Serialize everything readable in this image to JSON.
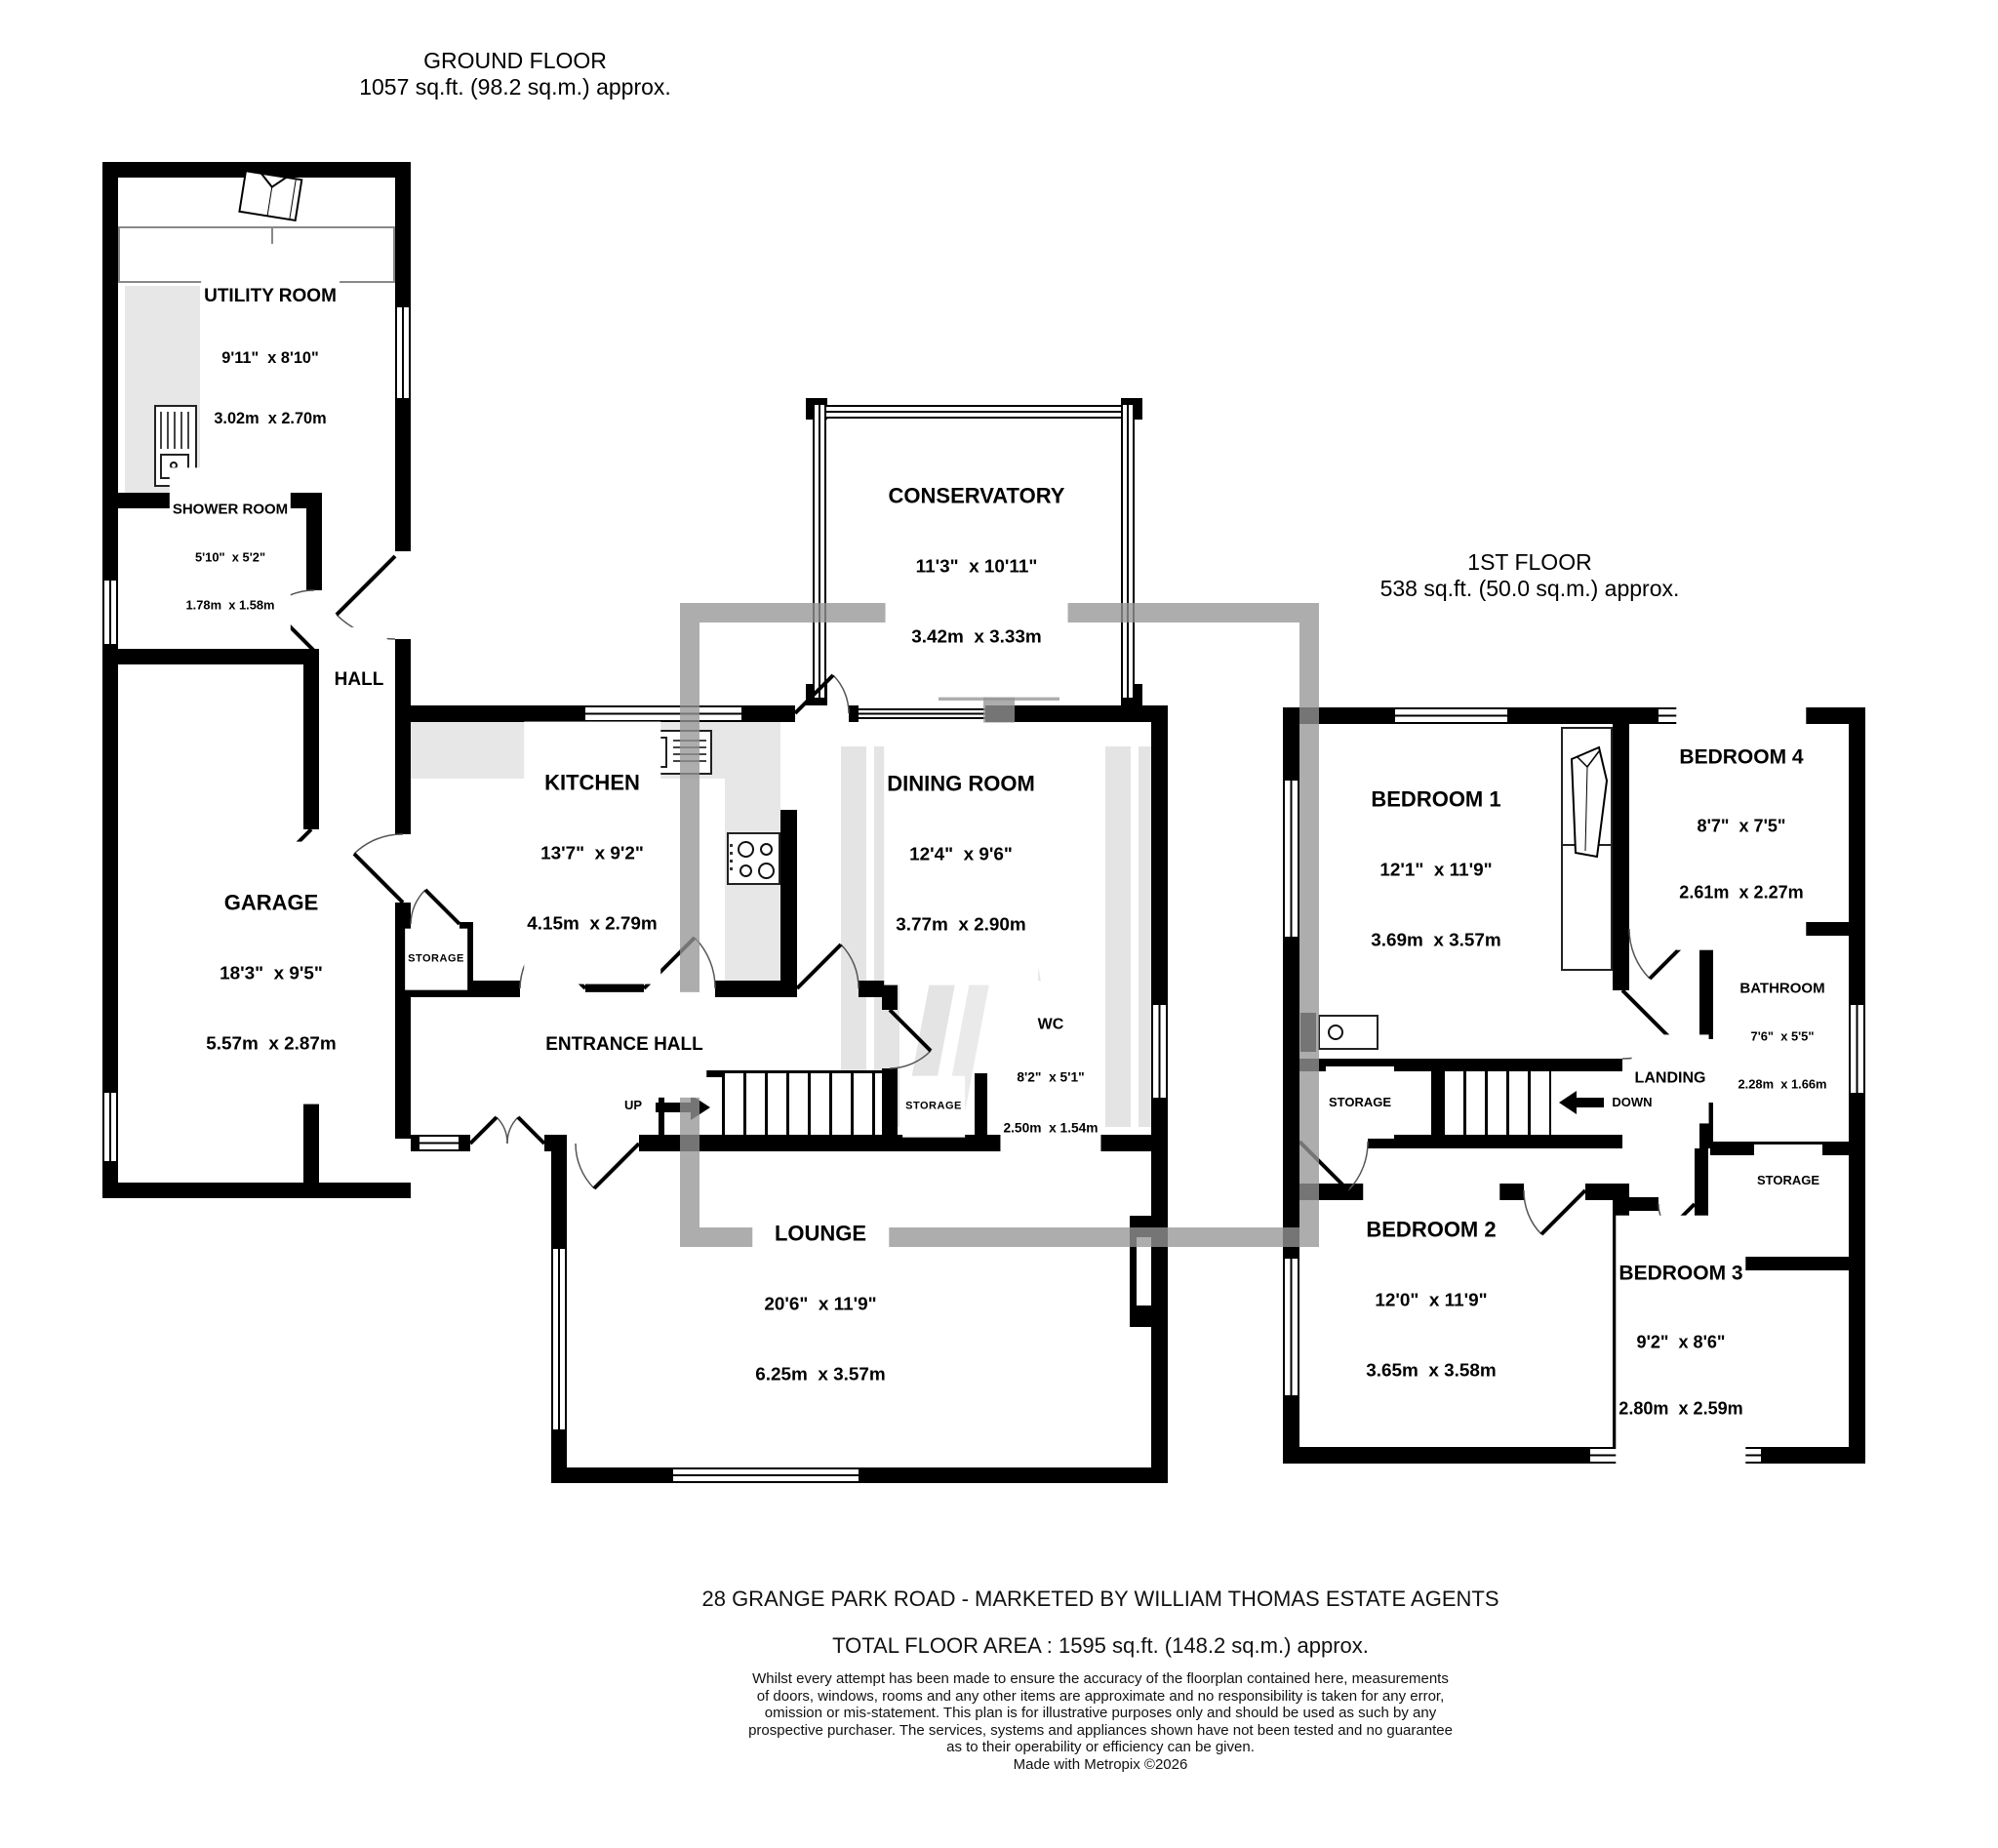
{
  "floors": {
    "ground": {
      "title": "GROUND FLOOR",
      "subtitle": "1057 sq.ft. (98.2 sq.m.) approx."
    },
    "first": {
      "title": "1ST FLOOR",
      "subtitle": "538 sq.ft. (50.0 sq.m.) approx."
    }
  },
  "rooms": {
    "utility": {
      "name": "UTILITY ROOM",
      "ft": "9'11\"  x 8'10\"",
      "m": "3.02m  x 2.70m"
    },
    "shower": {
      "name": "SHOWER ROOM",
      "ft": "5'10\"  x 5'2\"",
      "m": "1.78m  x 1.58m"
    },
    "hall": {
      "name": "HALL"
    },
    "garage": {
      "name": "GARAGE",
      "ft": "18'3\"  x 9'5\"",
      "m": "5.57m  x 2.87m"
    },
    "kitchen": {
      "name": "KITCHEN",
      "ft": "13'7\"  x 9'2\"",
      "m": "4.15m  x 2.79m"
    },
    "conservatory": {
      "name": "CONSERVATORY",
      "ft": "11'3\"  x 10'11\"",
      "m": "3.42m  x 3.33m"
    },
    "dining": {
      "name": "DINING ROOM",
      "ft": "12'4\"  x 9'6\"",
      "m": "3.77m  x 2.90m"
    },
    "entrance": {
      "name": "ENTRANCE HALL"
    },
    "wc": {
      "name": "WC",
      "ft": "8'2\"  x 5'1\"",
      "m": "2.50m  x 1.54m"
    },
    "storage_g1": {
      "name": "STORAGE"
    },
    "storage_g2": {
      "name": "STORAGE"
    },
    "lounge": {
      "name": "LOUNGE",
      "ft": "20'6\"  x 11'9\"",
      "m": "6.25m  x 3.57m"
    },
    "bed1": {
      "name": "BEDROOM 1",
      "ft": "12'1\"  x 11'9\"",
      "m": "3.69m  x 3.57m"
    },
    "bed2": {
      "name": "BEDROOM 2",
      "ft": "12'0\"  x 11'9\"",
      "m": "3.65m  x 3.58m"
    },
    "bed3": {
      "name": "BEDROOM 3",
      "ft": "9'2\"  x 8'6\"",
      "m": "2.80m  x 2.59m"
    },
    "bed4": {
      "name": "BEDROOM 4",
      "ft": "8'7\"  x 7'5\"",
      "m": "2.61m  x 2.27m"
    },
    "bathroom": {
      "name": "BATHROOM",
      "ft": "7'6\"  x 5'5\"",
      "m": "2.28m  x 1.66m"
    },
    "landing": {
      "name": "LANDING"
    },
    "storage_f1": {
      "name": "STORAGE"
    },
    "storage_f2": {
      "name": "STORAGE"
    }
  },
  "labels": {
    "up": "UP",
    "down": "DOWN"
  },
  "footer": {
    "address": "28 GRANGE PARK ROAD - MARKETED BY WILLIAM THOMAS ESTATE AGENTS",
    "total": "TOTAL FLOOR AREA : 1595 sq.ft. (148.2 sq.m.) approx.",
    "disclaimer_lines": [
      "Whilst every attempt has been made to ensure the accuracy of the floorplan contained here, measurements",
      "of doors, windows, rooms and any other items are approximate and no responsibility is taken for any error,",
      "omission or mis-statement. This plan is for illustrative purposes only and should be used as such by any",
      "prospective purchaser. The services, systems and appliances shown have not been tested and no guarantee",
      "as to their operability or efficiency can be given."
    ],
    "credit": "Made with Metropix ©2026"
  }
}
